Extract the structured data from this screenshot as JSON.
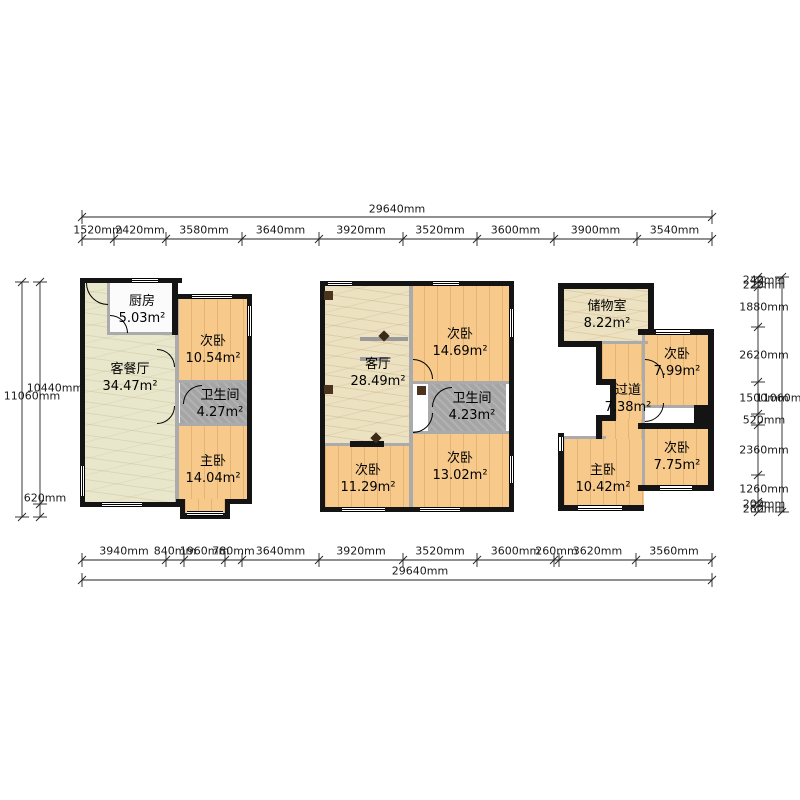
{
  "title": "三户型平面图",
  "plans": [
    {
      "id": "unit-a",
      "rooms": [
        {
          "name": "厨房",
          "area": "5.03m²"
        },
        {
          "name": "客餐厅",
          "area": "34.47m²"
        },
        {
          "name": "次卧",
          "area": "10.54m²"
        },
        {
          "name": "卫生间",
          "area": "4.27m²"
        },
        {
          "name": "主卧",
          "area": "14.04m²"
        }
      ]
    },
    {
      "id": "unit-b",
      "rooms": [
        {
          "name": "客厅",
          "area": "28.49m²"
        },
        {
          "name": "次卧",
          "area": "14.69m²"
        },
        {
          "name": "卫生间",
          "area": "4.23m²"
        },
        {
          "name": "次卧",
          "area": "11.29m²"
        },
        {
          "name": "次卧",
          "area": "13.02m²"
        }
      ]
    },
    {
      "id": "unit-c",
      "rooms": [
        {
          "name": "储物室",
          "area": "8.22m²"
        },
        {
          "name": "次卧",
          "area": "7.99m²"
        },
        {
          "name": "过道",
          "area": "7.38m²"
        },
        {
          "name": "主卧",
          "area": "10.42m²"
        },
        {
          "name": "次卧",
          "area": "7.75m²"
        }
      ]
    }
  ],
  "dimensions": {
    "top": {
      "total": "29640mm",
      "segments": [
        "1520mm",
        "2420mm",
        "3580mm",
        "3640mm",
        "3920mm",
        "3520mm",
        "3600mm",
        "3900mm",
        "3540mm"
      ]
    },
    "bottom": {
      "total": "29640mm",
      "segments": [
        "3940mm",
        "840mm",
        "1960mm",
        "780mm",
        "3640mm",
        "3920mm",
        "3520mm",
        "3600mm",
        "260mm",
        "3620mm",
        "3560mm"
      ]
    },
    "left": {
      "total": "11060mm",
      "segments": [
        "10440mm",
        "620mm"
      ]
    },
    "right": {
      "total": "11060mm",
      "segments": [
        "240mm",
        "220mm",
        "1880mm",
        "2620mm",
        "1500mm",
        "520mm",
        "2360mm",
        "1260mm",
        "200mm",
        "260mm"
      ]
    }
  },
  "colors": {
    "bedroom_fill": "#f7ca8c",
    "living_fill": "#ece1c0",
    "living_green_fill": "#e9e7cb",
    "bath_fill": "#a5a5a5",
    "wall": "#141414",
    "partition": "#ababab"
  }
}
